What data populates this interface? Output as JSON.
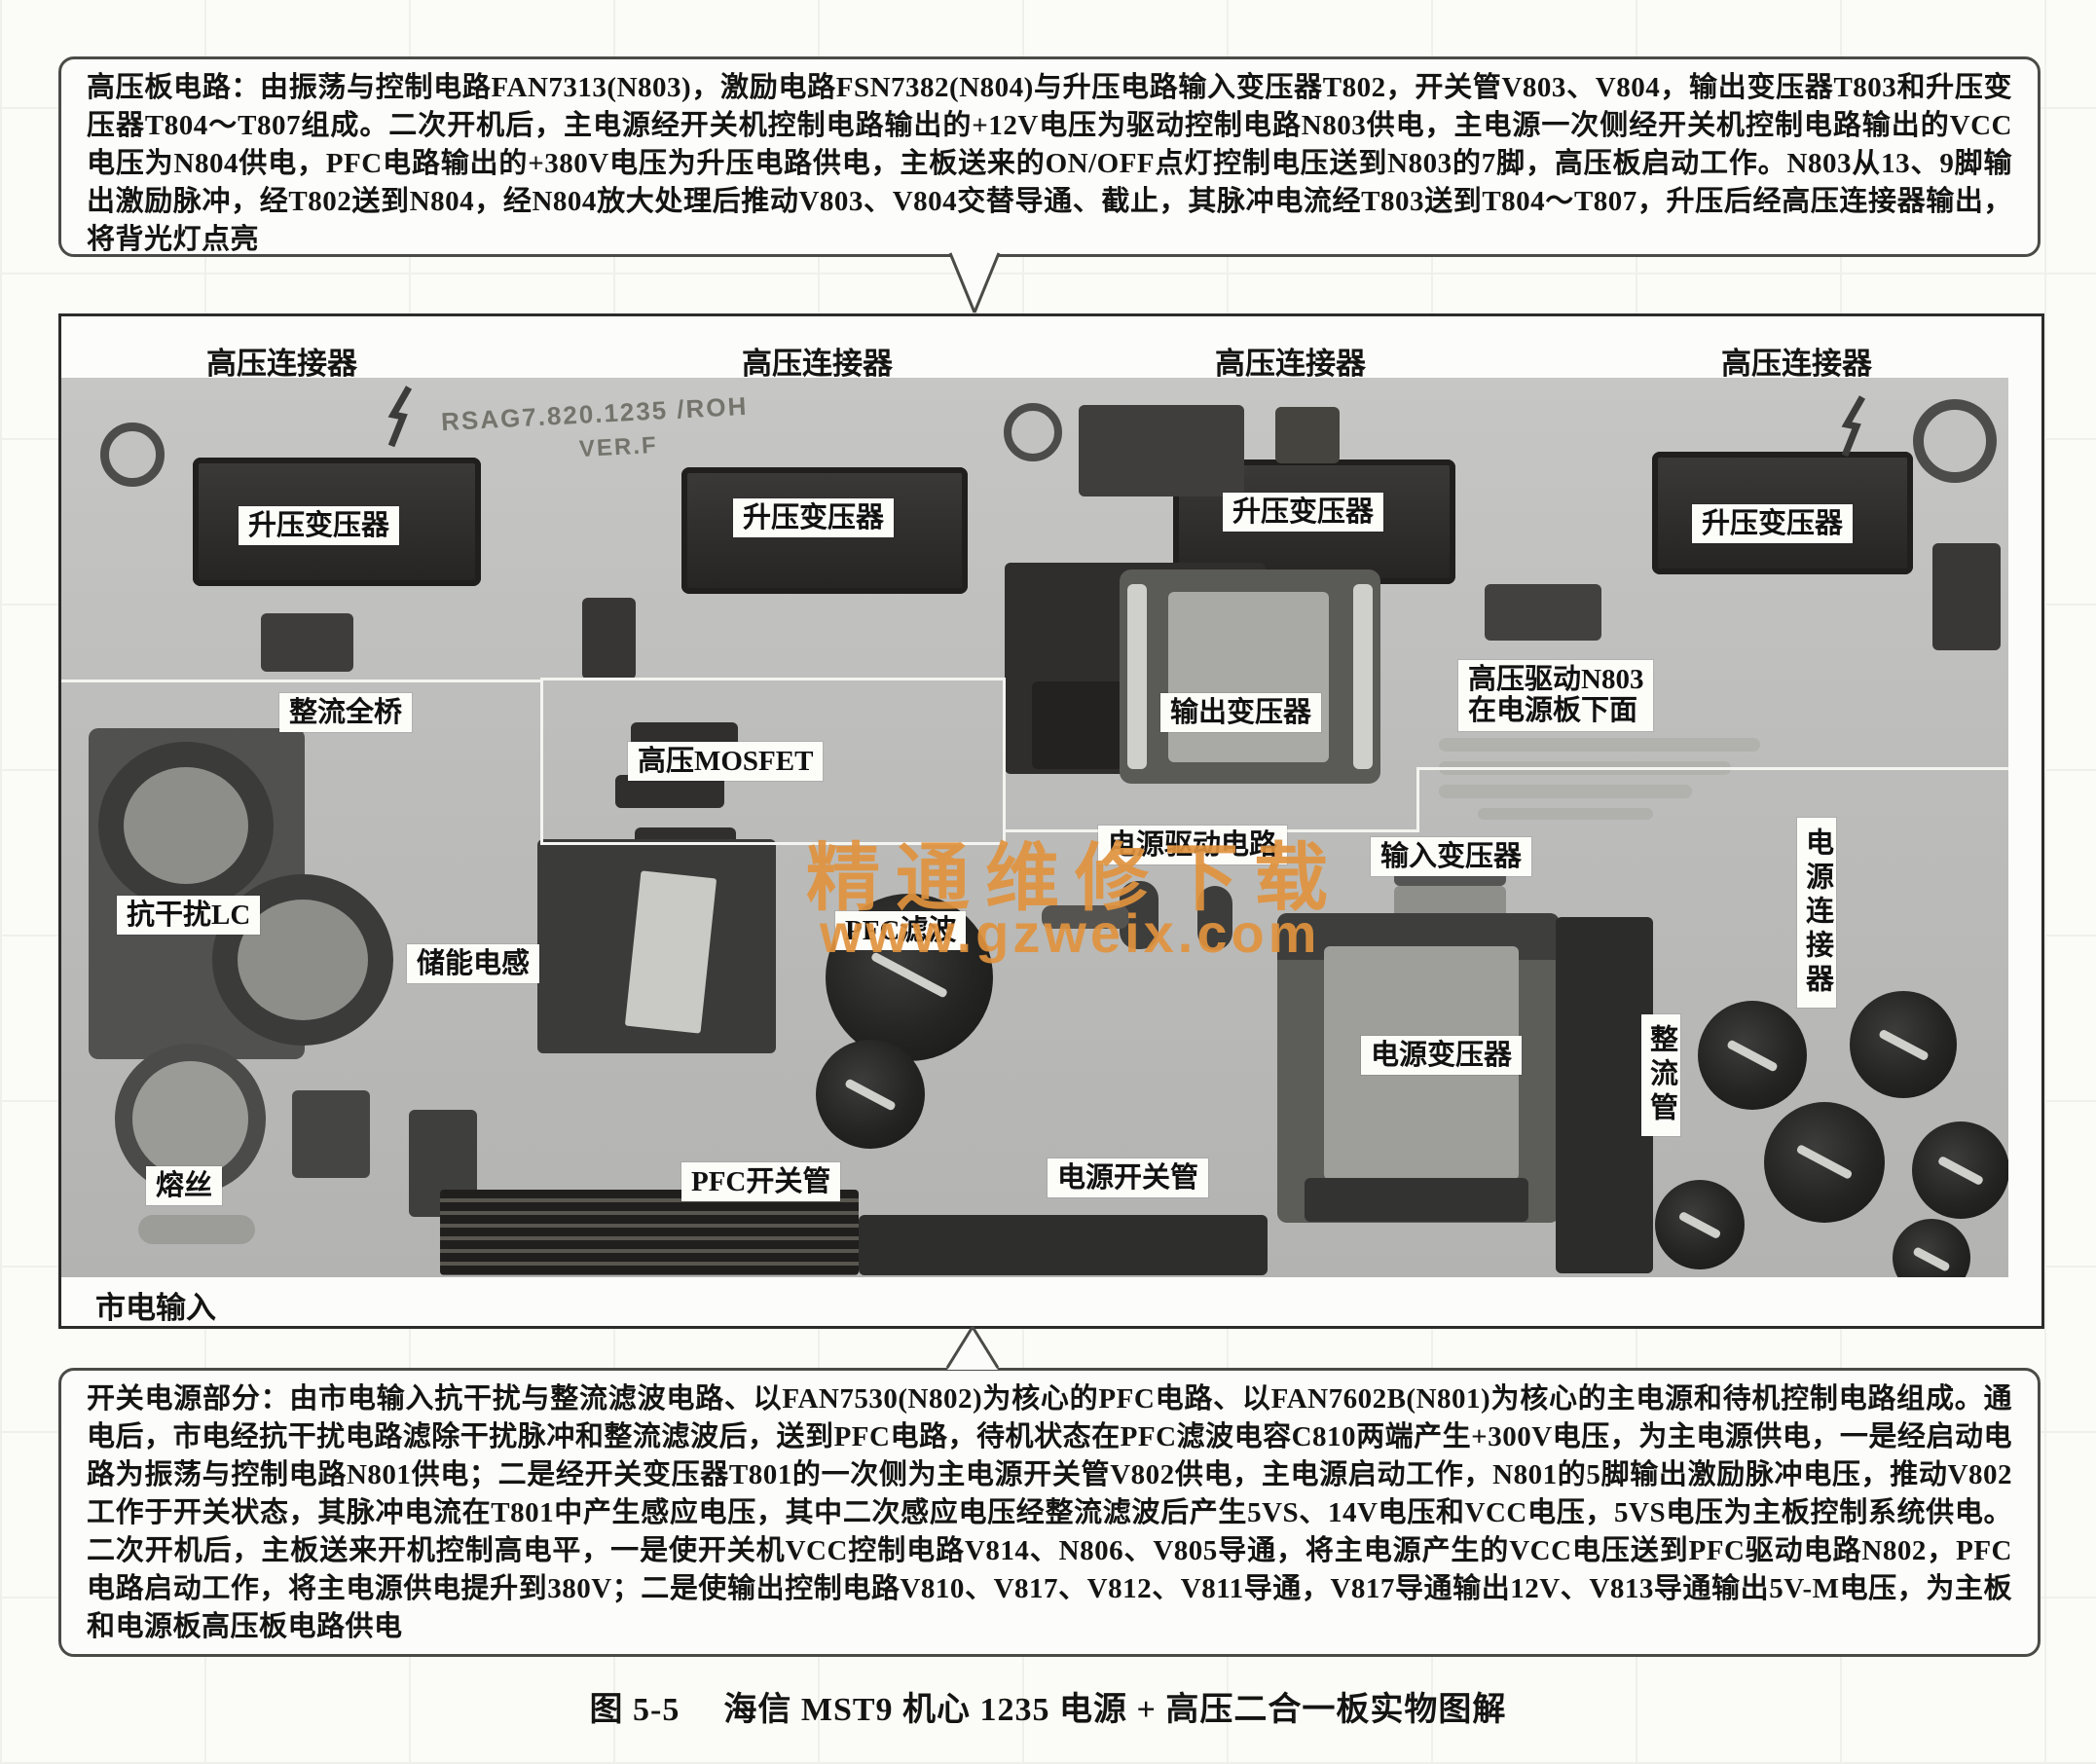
{
  "top_note": {
    "text": "高压板电路：由振荡与控制电路FAN7313(N803)，激励电路FSN7382(N804)与升压电路输入变压器T802，开关管V803、V804，输出变压器T803和升压变压器T804～T807组成。二次开机后，主电源经开关机控制电路输出的+12V电压为驱动控制电路N803供电，主电源一次侧经开关机控制电路输出的VCC电压为N804供电，PFC电路输出的+380V电压为升压电路供电，主板送来的ON/OFF点灯控制电压送到N803的7脚，高压板启动工作。N803从13、9脚输出激励脉冲，经T802送到N804，经N804放大处理后推动V803、V804交替导通、截止，其脉冲电流经T803送到T804～T807，升压后经高压连接器输出，将背光灯点亮"
  },
  "bottom_note": {
    "text": "开关电源部分：由市电输入抗干扰与整流滤波电路、以FAN7530(N802)为核心的PFC电路、以FAN7602B(N801)为核心的主电源和待机控制电路组成。通电后，市电经抗干扰电路滤除干扰脉冲和整流滤波后，送到PFC电路，待机状态在PFC滤波电容C810两端产生+300V电压，为主电源供电，一是经启动电路为振荡与控制电路N801供电；二是经开关变压器T801的一次侧为主电源开关管V802供电，主电源启动工作，N801的5脚输出激励脉冲电压，推动V802工作于开关状态，其脉冲电流在T801中产生感应电压，其中二次感应电压经整流滤波后产生5VS、14V电压和VCC电压，5VS电压为主板控制系统供电。二次开机后，主板送来开机控制高电平，一是使开关机VCC控制电路V814、N806、V805导通，将主电源产生的VCC电压送到PFC驱动电路N802，PFC电路启动工作，将主电源供电提升到380V；二是使输出控制电路V810、V817、V812、V811导通，V817导通输出12V、V813导通输出5V-M电压，为主板和电源板高压板电路供电"
  },
  "figure": {
    "caption_prefix": "图 5-5",
    "caption_text": "海信 MST9 机心 1235 电源 + 高压二合一板实物图解"
  },
  "board": {
    "silkscreen": "RSAG7.820.1235 /ROH",
    "silkscreen_ver": "VER.F",
    "watermark": {
      "line1": "精通维修下载",
      "line2": "www.gzweix.com",
      "color": "#E0923E"
    },
    "hv_connectors": [
      "高压连接器",
      "高压连接器",
      "高压连接器",
      "高压连接器"
    ],
    "boost_transformers": [
      "升压变压器",
      "升压变压器",
      "升压变压器",
      "升压变压器"
    ],
    "labels": {
      "bridge_rectifier": "整流全桥",
      "hv_mosfet": "高压MOSFET",
      "output_transformer": "输出变压器",
      "hv_driver_line1": "高压驱动N803",
      "hv_driver_line2": "在电源板下面",
      "power_driver": "电源驱动电路",
      "input_transformer": "输入变压器",
      "power_connector": "电源连接器",
      "emi_lc": "抗干扰LC",
      "storage_inductor": "储能电感",
      "pfc_filter": "PFC滤波",
      "power_transformer": "电源变压器",
      "rectifier_tubes": "整流管",
      "pfc_switch": "PFC开关管",
      "power_switch": "电源开关管",
      "fuse": "熔丝",
      "mains_input": "市电输入"
    }
  }
}
